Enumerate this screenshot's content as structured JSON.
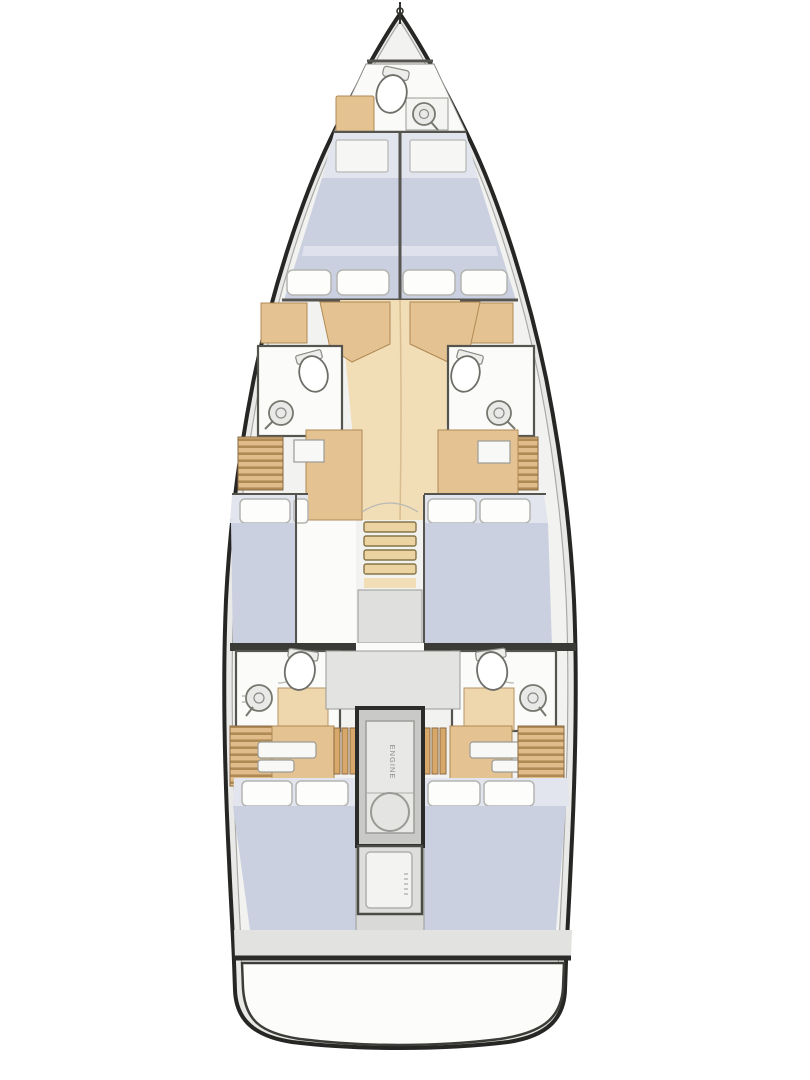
{
  "labels": {
    "engine": "ENGINE"
  },
  "colors": {
    "hull_outline": "#262624",
    "hull_fill": "#e9e9e7",
    "deck": "#f2f2f0",
    "wall": "#55544e",
    "berth": "#cbd0e0",
    "berth_light": "#e2e4ee",
    "pillow": "#fdfdfc",
    "wood": "#e5c291",
    "wood_light": "#f1ddb6",
    "wood_dark": "#b08a55",
    "room": "#fbfbf9",
    "grey_zone": "#dfdfdd"
  },
  "plan": {
    "type": "sailing-yacht-interior-deck-plan",
    "orientation": "bow-up",
    "features": [
      "bow-anchor-fitting",
      "bow-head-with-toilet-and-sink",
      "forward-twin-double-cabins-with-four-pillows",
      "port-forward-head",
      "starboard-forward-head",
      "central-wood-corridor-with-companionway-stairs",
      "port-mid-cabin-berth",
      "starboard-mid-double-cabin",
      "port-aft-head",
      "starboard-aft-head",
      "central-engine-compartment",
      "port-aft-double-cabin",
      "starboard-aft-double-cabin",
      "stern-hatch-locker",
      "swim-platform"
    ]
  }
}
